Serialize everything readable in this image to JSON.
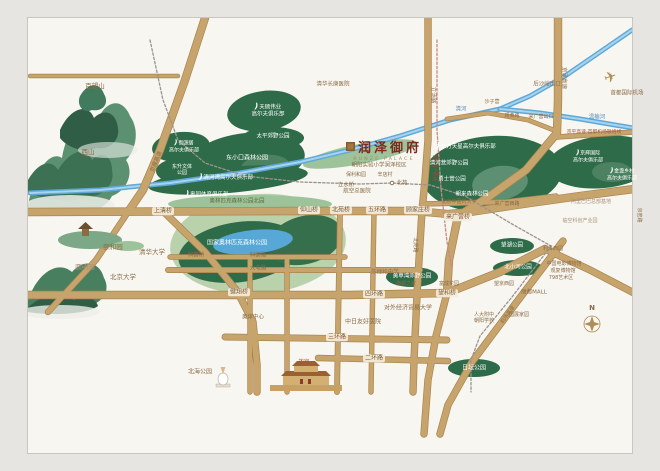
{
  "logo": {
    "title": "润泽御府",
    "subtitle": "RUNZE PALACE"
  },
  "compass": {
    "n": "N"
  },
  "colors": {
    "road": "#c6a46c",
    "road_edge": "#a8854f",
    "river": "#5fa8d8",
    "river_hl": "#a6d4ee",
    "park_dark": "#2e6c49",
    "park_light": "#9cc39a",
    "metro": "#9a948c",
    "metro17": "#c98b7e",
    "accent_red": "#b5432f",
    "gold": "#a98a55",
    "text_brown": "#8a6b45"
  },
  "map": {
    "parks": [
      [
        258,
        244,
        88,
        50,
        -4,
        "#b9d2ac"
      ],
      [
        250,
        204,
        82,
        9,
        0,
        "#9cc39a"
      ],
      [
        360,
        154,
        58,
        10,
        -11,
        "#9cc39a"
      ],
      [
        240,
        252,
        62,
        30,
        -8,
        "#2e6c49"
      ],
      [
        305,
        240,
        38,
        24,
        -15,
        "#356f4c"
      ],
      [
        247,
        160,
        58,
        27,
        -6,
        "#2e6c49"
      ],
      [
        265,
        166,
        24,
        11,
        -6,
        "#4c8161"
      ],
      [
        264,
        111,
        37,
        20,
        -8,
        "#2e6c49"
      ],
      [
        181,
        147,
        29,
        15,
        -5,
        "#2e6c49"
      ],
      [
        182,
        171,
        26,
        13,
        0,
        "#2e6c49"
      ],
      [
        273,
        138,
        31,
        11,
        0,
        "#2e6c49"
      ],
      [
        228,
        180,
        80,
        13,
        -5,
        "#2e6c49"
      ],
      [
        492,
        174,
        70,
        38,
        -4,
        "#2e6c49"
      ],
      [
        500,
        183,
        28,
        17,
        -8,
        "#5d8f72"
      ],
      [
        603,
        162,
        56,
        26,
        -6,
        "#2e6c49"
      ],
      [
        612,
        172,
        20,
        10,
        0,
        "#4c8161"
      ],
      [
        412,
        277,
        26,
        10,
        0,
        "#2e6c49"
      ],
      [
        512,
        246,
        22,
        8,
        0,
        "#2e6c49"
      ],
      [
        518,
        268,
        25,
        8,
        0,
        "#2e6c49"
      ],
      [
        474,
        368,
        26,
        9,
        0,
        "#2e6c49"
      ],
      [
        253,
        242,
        40,
        12,
        -6,
        "#57a8d6"
      ]
    ],
    "rivers": [
      {
        "p": [
          [
            30,
            193
          ],
          [
            100,
            190
          ],
          [
            170,
            183
          ],
          [
            240,
            173
          ],
          [
            300,
            162
          ],
          [
            350,
            150
          ],
          [
            400,
            136
          ],
          [
            450,
            120
          ],
          [
            500,
            109
          ]
        ]
      },
      {
        "p": [
          [
            632,
            30
          ],
          [
            600,
            52
          ],
          [
            565,
            76
          ],
          [
            530,
            96
          ],
          [
            500,
            109
          ]
        ]
      },
      {
        "p": [
          [
            500,
            109
          ],
          [
            540,
            113
          ],
          [
            580,
            119
          ],
          [
            615,
            125
          ],
          [
            640,
            129
          ]
        ]
      }
    ],
    "roads": [
      {
        "p": [
          [
            30,
            76
          ],
          [
            178,
            76
          ]
        ],
        "w": 3
      },
      {
        "p": [
          [
            205,
            18
          ],
          [
            185,
            80
          ],
          [
            160,
            150
          ],
          [
            143,
            190
          ],
          [
            128,
            212
          ]
        ],
        "w": 7
      },
      {
        "p": [
          [
            128,
            212
          ],
          [
            96,
            260
          ],
          [
            48,
            312
          ]
        ],
        "w": 5
      },
      {
        "p": [
          [
            164,
            212
          ],
          [
            205,
            252
          ],
          [
            237,
            291
          ],
          [
            253,
            322
          ],
          [
            257,
            365
          ],
          [
            257,
            392
          ]
        ],
        "w": 6
      },
      {
        "p": [
          [
            28,
            212
          ],
          [
            300,
            211
          ],
          [
            415,
            211
          ],
          [
            448,
            214
          ],
          [
            470,
            212
          ],
          [
            530,
            203
          ],
          [
            580,
            196
          ],
          [
            634,
            189
          ]
        ],
        "w": 7
      },
      {
        "p": [
          [
            28,
            295
          ],
          [
            350,
            295
          ],
          [
            447,
            293
          ],
          [
            500,
            272
          ],
          [
            545,
            249
          ]
        ],
        "w": 7
      },
      {
        "p": [
          [
            545,
            249
          ],
          [
            590,
            270
          ],
          [
            634,
            293
          ]
        ],
        "w": 6
      },
      {
        "p": [
          [
            563,
            241
          ],
          [
            516,
            303
          ],
          [
            472,
            362
          ],
          [
            448,
            405
          ],
          [
            440,
            434
          ]
        ],
        "w": 6
      },
      {
        "p": [
          [
            558,
            18
          ],
          [
            558,
            100
          ],
          [
            557,
            133
          ],
          [
            526,
            170
          ],
          [
            487,
            198
          ],
          [
            458,
            216
          ],
          [
            449,
            260
          ],
          [
            447,
            293
          ]
        ],
        "w": 7
      },
      {
        "p": [
          [
            447,
            293
          ],
          [
            436,
            336
          ],
          [
            428,
            380
          ],
          [
            424,
            434
          ]
        ],
        "w": 6
      },
      {
        "p": [
          [
            428,
            18
          ],
          [
            428,
            100
          ],
          [
            428,
            140
          ],
          [
            425,
            180
          ],
          [
            422,
            211
          ],
          [
            419,
            260
          ],
          [
            417,
            295
          ],
          [
            414,
            360
          ],
          [
            413,
            392
          ]
        ],
        "w": 6
      },
      {
        "p": [
          [
            641,
            140
          ],
          [
            641,
            284
          ]
        ],
        "w": 5
      },
      {
        "p": [
          [
            170,
            257
          ],
          [
            345,
            257
          ]
        ],
        "w": 4
      },
      {
        "p": [
          [
            168,
            270
          ],
          [
            420,
            270
          ]
        ],
        "w": 4.5
      },
      {
        "p": [
          [
            250,
            257
          ],
          [
            250,
            392
          ]
        ],
        "w": 4
      },
      {
        "p": [
          [
            287,
            257
          ],
          [
            287,
            392
          ]
        ],
        "w": 4
      },
      {
        "p": [
          [
            340,
            211
          ],
          [
            337,
            392
          ]
        ],
        "w": 4.5
      },
      {
        "p": [
          [
            374,
            211
          ],
          [
            371,
            392
          ]
        ],
        "w": 4
      },
      {
        "p": [
          [
            225,
            337
          ],
          [
            447,
            340
          ]
        ],
        "w": 5.5
      },
      {
        "p": [
          [
            318,
            358
          ],
          [
            448,
            361
          ]
        ],
        "w": 5
      },
      {
        "p": [
          [
            422,
            204
          ],
          [
            505,
            202
          ],
          [
            556,
            196
          ]
        ],
        "w": 4
      },
      {
        "p": [
          [
            447,
            119
          ],
          [
            488,
            113
          ],
          [
            528,
            120
          ],
          [
            556,
            131
          ]
        ],
        "w": 3.5
      },
      {
        "p": [
          [
            557,
            137
          ],
          [
            634,
            132
          ]
        ],
        "w": 4
      }
    ],
    "metro": [
      {
        "p": [
          [
            150,
            40
          ],
          [
            163,
            100
          ],
          [
            178,
            140
          ],
          [
            205,
            163
          ],
          [
            245,
            176
          ],
          [
            300,
            182
          ],
          [
            360,
            184
          ],
          [
            392,
            183
          ],
          [
            430,
            185
          ],
          [
            465,
            196
          ],
          [
            512,
            224
          ],
          [
            551,
            246
          ]
        ],
        "c": "#9a948c"
      },
      {
        "p": [
          [
            551,
            246
          ],
          [
            512,
            297
          ],
          [
            480,
            336
          ],
          [
            471,
            360
          ],
          [
            471,
            392
          ]
        ],
        "c": "#9a948c"
      },
      {
        "p": [
          [
            437,
            40
          ],
          [
            437,
            130
          ],
          [
            441,
            188
          ],
          [
            447,
            242
          ],
          [
            452,
            270
          ]
        ],
        "c": "#c98b7e"
      }
    ],
    "stations": [
      [
        392,
        183
      ]
    ],
    "labels": [
      {
        "t": "百望山",
        "x": 95,
        "y": 86
      },
      {
        "t": "西山",
        "x": 88,
        "y": 152
      },
      {
        "t": "颐和园",
        "x": 113,
        "y": 247
      },
      {
        "t": "圆明园",
        "x": 85,
        "y": 267,
        "c": "faint"
      },
      {
        "t": "北京大学",
        "x": 123,
        "y": 277
      },
      {
        "t": "清华大学",
        "x": 152,
        "y": 252
      },
      {
        "t": "清华长庚医院",
        "x": 333,
        "y": 85,
        "s": 5.5
      },
      {
        "t": "科荟桥",
        "x": 196,
        "y": 256,
        "s": 5.5
      },
      {
        "t": "科荟路",
        "x": 258,
        "y": 256,
        "s": 5.5
      },
      {
        "t": "大屯路",
        "x": 258,
        "y": 269,
        "s": 5.5
      },
      {
        "t": "上清桥",
        "x": 163,
        "y": 211,
        "c": "pill"
      },
      {
        "t": "健翔桥",
        "x": 239,
        "y": 292,
        "c": "pill"
      },
      {
        "t": "仰山桥",
        "x": 309,
        "y": 210,
        "c": "pill"
      },
      {
        "t": "北苑桥",
        "x": 341,
        "y": 210,
        "c": "pill"
      },
      {
        "t": "五环路",
        "x": 377,
        "y": 210,
        "c": "pill"
      },
      {
        "t": "顾家庄桥",
        "x": 418,
        "y": 210,
        "c": "pill"
      },
      {
        "t": "来广营桥",
        "x": 458,
        "y": 217,
        "c": "pill"
      },
      {
        "t": "望和桥",
        "x": 447,
        "y": 293,
        "c": "pill"
      },
      {
        "t": "四环路",
        "x": 374,
        "y": 294,
        "c": "pill"
      },
      {
        "t": "三环路",
        "x": 337,
        "y": 337,
        "c": "pill"
      },
      {
        "t": "二环路",
        "x": 374,
        "y": 358,
        "c": "pill"
      },
      {
        "t": "立水桥",
        "x": 346,
        "y": 186,
        "s": 5.5
      },
      {
        "t": "北苑",
        "x": 402,
        "y": 184,
        "s": 5.5
      },
      {
        "t": "朝阳实验小学润泽校区",
        "x": 379,
        "y": 166,
        "s": 5.5
      },
      {
        "t": "保利和园",
        "x": 356,
        "y": 175,
        "s": 5
      },
      {
        "t": "辛店村",
        "x": 385,
        "y": 175,
        "s": 5
      },
      {
        "t": "航空总医院",
        "x": 357,
        "y": 192,
        "s": 5.5
      },
      {
        "t": "北京中医药大学",
        "x": 459,
        "y": 202,
        "s": 5
      },
      {
        "t": "来广营西路",
        "x": 507,
        "y": 204,
        "s": 5
      },
      {
        "t": "陈经纶中学",
        "x": 385,
        "y": 273,
        "s": 5.5
      },
      {
        "t": "旗舰之家",
        "x": 406,
        "y": 284,
        "s": 5
      },
      {
        "t": "富成花园",
        "x": 449,
        "y": 284,
        "s": 5
      },
      {
        "t": "望京西园",
        "x": 504,
        "y": 284,
        "s": 5
      },
      {
        "t": "利泽西园",
        "x": 553,
        "y": 249,
        "s": 5
      },
      {
        "t": "中国电影博物馆",
        "x": 564,
        "y": 264,
        "s": 5
      },
      {
        "t": "观复博物馆",
        "x": 563,
        "y": 271,
        "s": 5
      },
      {
        "t": "798艺术区",
        "x": 561,
        "y": 278,
        "s": 5
      },
      {
        "t": "丽都MALL",
        "x": 534,
        "y": 293,
        "s": 5.5
      },
      {
        "t": "国展家园",
        "x": 519,
        "y": 315,
        "s": 5
      },
      {
        "t": "人大附中\n朝阳学校",
        "x": 484,
        "y": 318,
        "s": 5
      },
      {
        "t": "对外经济贸易大学",
        "x": 408,
        "y": 308,
        "s": 6
      },
      {
        "t": "中日友好医院",
        "x": 363,
        "y": 322,
        "s": 6
      },
      {
        "t": "奥体中心",
        "x": 253,
        "y": 318,
        "s": 5.5
      },
      {
        "t": "北海公园",
        "x": 200,
        "y": 372,
        "s": 6
      },
      {
        "t": "故宫",
        "x": 304,
        "y": 363,
        "c": "rbrown",
        "s": 5.5
      },
      {
        "t": "沙子营",
        "x": 492,
        "y": 102,
        "s": 5
      },
      {
        "t": "顺黄路",
        "x": 512,
        "y": 116,
        "s": 5
      },
      {
        "t": "来广营出口",
        "x": 541,
        "y": 117,
        "s": 5
      },
      {
        "t": "后沙峪出口",
        "x": 547,
        "y": 85,
        "s": 5.5
      },
      {
        "t": "首都国际机场",
        "x": 627,
        "y": 94,
        "s": 5.5
      },
      {
        "t": "清河",
        "x": 461,
        "y": 110,
        "c": "blue",
        "s": 5.5
      },
      {
        "t": "温榆河",
        "x": 597,
        "y": 118,
        "c": "blue",
        "s": 5.5
      },
      {
        "t": "阿里巴巴总部基地",
        "x": 591,
        "y": 202,
        "c": "faint",
        "s": 5
      },
      {
        "t": "临空科创产业园",
        "x": 580,
        "y": 221,
        "c": "faint",
        "s": 5
      },
      {
        "t": "奥林匹克森林公园北园",
        "x": 237,
        "y": 202,
        "c": "olive",
        "s": 5.5
      },
      {
        "t": "京平高速-首都机场联络线",
        "x": 594,
        "y": 133,
        "c": "rbrown",
        "s": 4.8
      },
      {
        "t": "地铁17号线",
        "x": 434,
        "y": 168,
        "c": "red",
        "r": 90,
        "s": 5
      },
      {
        "t": "京藏高速",
        "x": 157,
        "y": 162,
        "r": -68,
        "s": 5.5
      },
      {
        "t": "立汤路",
        "x": 432,
        "y": 95,
        "r": 90,
        "s": 5.5
      },
      {
        "t": "京承高速",
        "x": 563,
        "y": 78,
        "r": 90,
        "s": 5.5
      },
      {
        "t": "北苑路",
        "x": 415,
        "y": 245,
        "r": 90,
        "s": 5
      },
      {
        "t": "京密路",
        "x": 639,
        "y": 215,
        "r": 90,
        "s": 5
      },
      {
        "t": "机场高速",
        "x": 508,
        "y": 315,
        "r": -55,
        "s": 5
      },
      {
        "t": "天硕伟业\n高尔夫俱乐部",
        "x": 268,
        "y": 110,
        "c": "park",
        "g": 1,
        "s": 5.5
      },
      {
        "t": "御源居\n高尔夫俱乐部",
        "x": 184,
        "y": 146,
        "c": "park",
        "g": 1,
        "s": 5
      },
      {
        "t": "东升文体\n公园",
        "x": 182,
        "y": 170,
        "c": "park",
        "s": 5
      },
      {
        "t": "东小口森林公园",
        "x": 247,
        "y": 158,
        "c": "park",
        "s": 6
      },
      {
        "t": "太平郊野公园",
        "x": 273,
        "y": 137,
        "c": "park",
        "s": 5.5
      },
      {
        "t": "清河湾高尔夫俱乐部",
        "x": 226,
        "y": 177,
        "c": "park",
        "g": 1,
        "s": 5.5
      },
      {
        "t": "奥园体育俱乐部",
        "x": 207,
        "y": 194,
        "c": "park",
        "g": 1,
        "s": 5.5
      },
      {
        "t": "国家奥林匹克森林公园",
        "x": 237,
        "y": 243,
        "c": "park",
        "s": 6
      },
      {
        "t": "东方天星高尔夫俱乐部",
        "x": 466,
        "y": 146,
        "c": "park",
        "g": 1,
        "s": 5.5
      },
      {
        "t": "清河营郊野公园",
        "x": 449,
        "y": 164,
        "c": "park",
        "s": 5.5
      },
      {
        "t": "勇士营公园",
        "x": 452,
        "y": 180,
        "c": "park",
        "s": 5.5
      },
      {
        "t": "朝来森林公园",
        "x": 472,
        "y": 195,
        "c": "park",
        "s": 5.5
      },
      {
        "t": "京辉国际\n高尔夫俱乐部",
        "x": 588,
        "y": 156,
        "c": "park",
        "g": 1,
        "s": 5
      },
      {
        "t": "金盏乡村\n高尔夫俱乐部",
        "x": 622,
        "y": 174,
        "c": "park",
        "g": 1,
        "s": 5
      },
      {
        "t": "黄草湾郊野公园",
        "x": 412,
        "y": 277,
        "c": "park",
        "s": 5.5
      },
      {
        "t": "望湖公园",
        "x": 512,
        "y": 246,
        "c": "park",
        "s": 5.5
      },
      {
        "t": "北小河公园",
        "x": 518,
        "y": 268,
        "c": "park",
        "s": 5.5
      },
      {
        "t": "日坛公园",
        "x": 474,
        "y": 368,
        "c": "park",
        "s": 6
      }
    ]
  }
}
